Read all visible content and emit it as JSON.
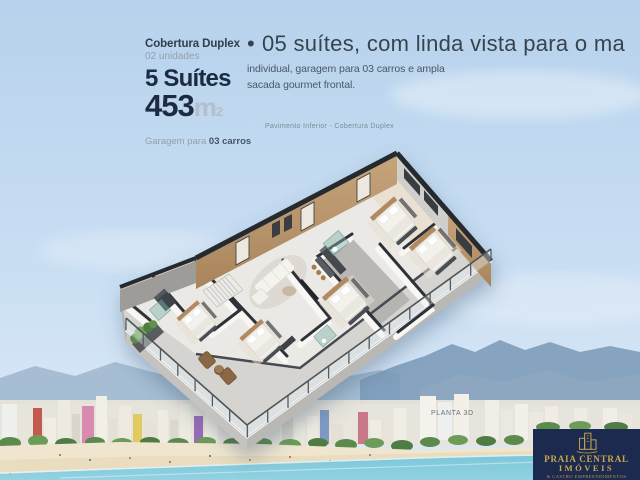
{
  "palette": {
    "navy": "#1c2a42",
    "logo_navy": "#1d2a50",
    "gold": "#c9a84c",
    "sky_top": "#b7d2ec",
    "sea": "#7ac6d8",
    "text_dark": "#36444f",
    "text_gray": "#93a0ac"
  },
  "left_panel": {
    "title": "Cobertura Duplex",
    "units": "02 unidades",
    "suites": "5 Suítes",
    "area_value": "453",
    "area_unit": "m",
    "area_exp": "2",
    "garage_prefix": "Garagem para ",
    "garage_bold": "03 carros"
  },
  "headline": {
    "bullet": "•",
    "line1": "05 suítes, com linda vista para o ma",
    "line2": "individual, garagem para 03 carros e ampla",
    "line3": "sacada gourmet frontal."
  },
  "floorplan": {
    "caption": "Pavimento Inferior - Cobertura Duplex",
    "watermark": "PLANTA 3D"
  },
  "logo": {
    "line1": "PRAIA CENTRAL",
    "line2": "IMÓVEIS",
    "tagline": "& CASTRO EMPREENDIMENTOS"
  }
}
